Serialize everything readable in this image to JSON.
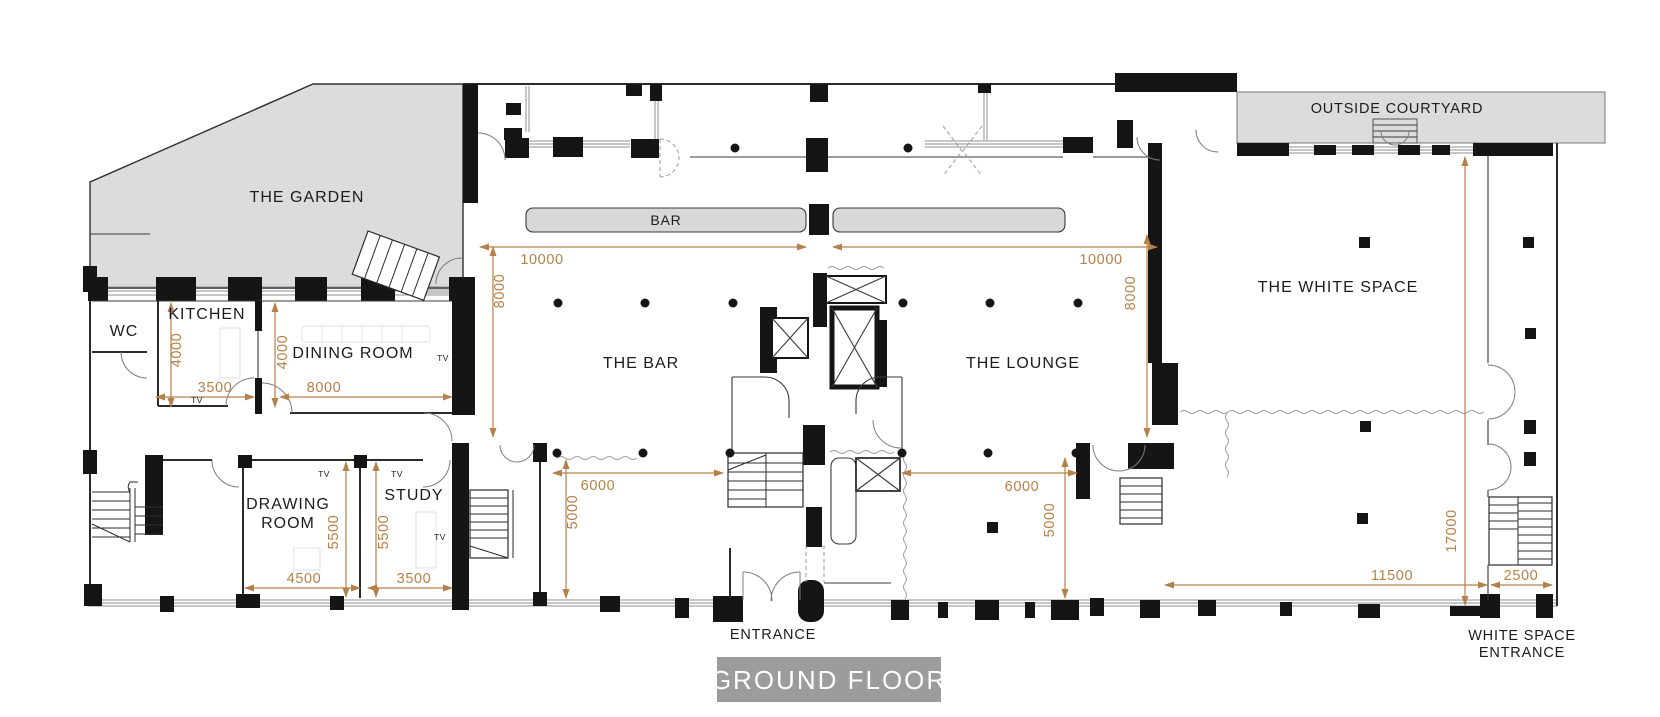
{
  "plan": {
    "title": "GROUND FLOOR",
    "annotation_color": "#b5814a",
    "area_fill_color": "#dcdcdc",
    "badge_color": "#9c9c9c",
    "rooms": {
      "garden": "THE GARDEN",
      "courtyard": "OUTSIDE COURTYARD",
      "white_space": "THE WHITE SPACE",
      "bar_room": "THE BAR",
      "lounge": "THE LOUNGE",
      "kitchen": "KITCHEN",
      "dining": "DINING ROOM",
      "wc": "WC",
      "drawing_line1": "DRAWING",
      "drawing_line2": "ROOM",
      "study": "STUDY"
    },
    "labels": {
      "bar_counter": "BAR",
      "entrance": "ENTRANCE",
      "white_space_entrance_line1": "WHITE SPACE",
      "white_space_entrance_line2": "ENTRANCE",
      "tv": "TV"
    },
    "dimensions": {
      "bar_w": "10000",
      "bar_h": "8000",
      "lounge_w": "10000",
      "lounge_h": "8000",
      "kitchen_h": "4000",
      "kitchen_w": "3500",
      "dining_h": "4000",
      "dining_w": "8000",
      "bar_low_w": "6000",
      "bar_low_h": "5000",
      "lounge_low_w": "6000",
      "lounge_low_h": "5000",
      "drawing_h": "5500",
      "drawing_w": "4500",
      "study_h": "5500",
      "study_w": "3500",
      "ws_h": "17000",
      "ws_w": "11500",
      "ws_entry_w": "2500"
    }
  }
}
